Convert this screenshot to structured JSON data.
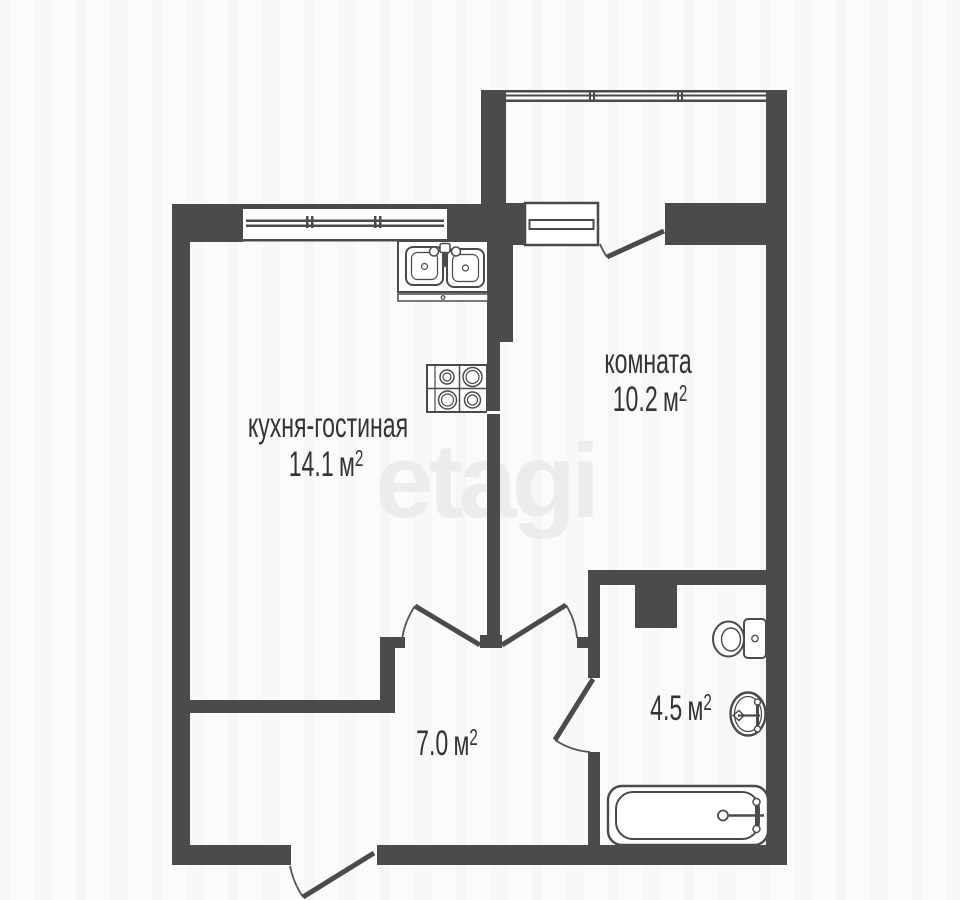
{
  "watermark": "etagi",
  "colors": {
    "wall": "#4b4b4b",
    "line": "#4a4a4a",
    "text": "#333333",
    "watermark": "#ececec",
    "background": "#fbfbfb"
  },
  "rooms": [
    {
      "key": "kitchen-living",
      "label": "кухня-гостиная",
      "area_value": "14.1",
      "unit": "м",
      "unit_sup": "2"
    },
    {
      "key": "room",
      "label": "комната",
      "area_value": "10.2",
      "unit": "м",
      "unit_sup": "2"
    },
    {
      "key": "hallway",
      "label": "",
      "area_value": "7.0",
      "unit": "м",
      "unit_sup": "2"
    },
    {
      "key": "bathroom",
      "label": "",
      "area_value": "4.5",
      "unit": "м",
      "unit_sup": "2"
    }
  ],
  "fixtures": [
    "double-kitchen-sink",
    "cooktop-4-burner",
    "toilet",
    "washbasin",
    "bathtub",
    "ventilation-shaft"
  ],
  "openings": {
    "windows": [
      "kitchen-window",
      "balcony-glazing",
      "balcony-window"
    ],
    "doors": [
      "entrance-door",
      "kitchen-hall-door",
      "room-hall-door",
      "bathroom-door",
      "balcony-door"
    ]
  }
}
